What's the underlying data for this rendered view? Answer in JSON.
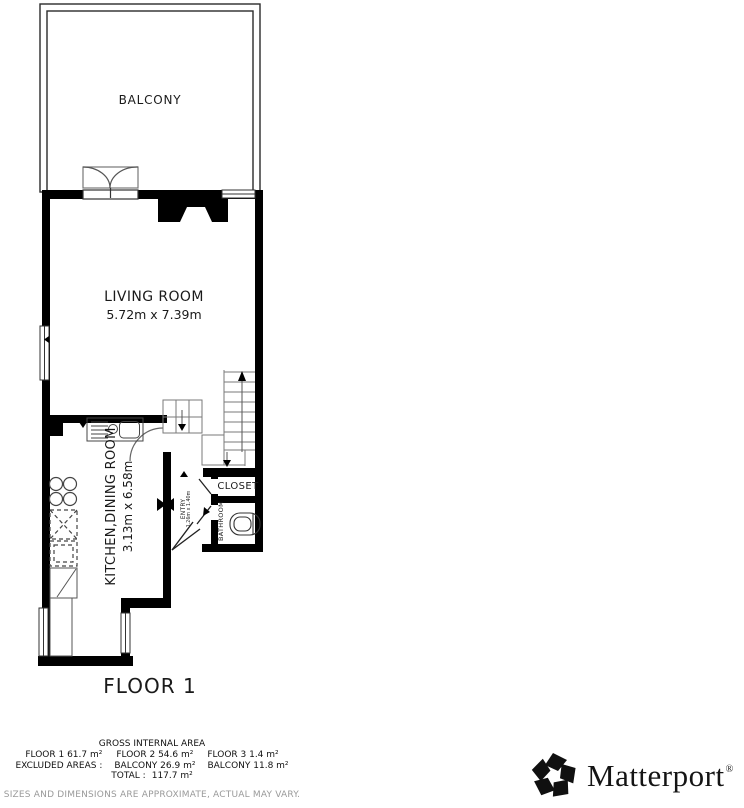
{
  "plan": {
    "floor_label": "FLOOR 1",
    "rooms": {
      "balcony": {
        "name": "BALCONY"
      },
      "living_room": {
        "name": "LIVING ROOM",
        "dimensions": "5.72m x 7.39m"
      },
      "kitchen_dining": {
        "name": "KITCHEN,DINING ROOM",
        "dimensions": "3.13m x 6.58m"
      },
      "entry": {
        "name": "ENTRY",
        "dimensions": "1.26m x 1.40m"
      },
      "closet": {
        "name": "CLOSET"
      },
      "bathroom": {
        "name": "BATHROOM"
      }
    }
  },
  "footer": {
    "title": "GROSS INTERNAL AREA",
    "floors": [
      "FLOOR 1 61.7 m²",
      "FLOOR 2 54.6 m²",
      "FLOOR 3 1.4 m²"
    ],
    "excluded_label": "EXCLUDED AREAS :",
    "excluded": [
      "BALCONY 26.9 m²",
      "BALCONY 11.8 m²"
    ],
    "total_label": "TOTAL :",
    "total_value": "117.7 m²",
    "disclaimer": "SIZES AND DIMENSIONS ARE APPROXIMATE, ACTUAL MAY VARY."
  },
  "brand": {
    "name": "Matterport",
    "registered": "®"
  },
  "colors": {
    "wall": "#000000",
    "text": "#1a1a1a",
    "muted": "#9a9a9a",
    "thin_line": "#555555"
  }
}
